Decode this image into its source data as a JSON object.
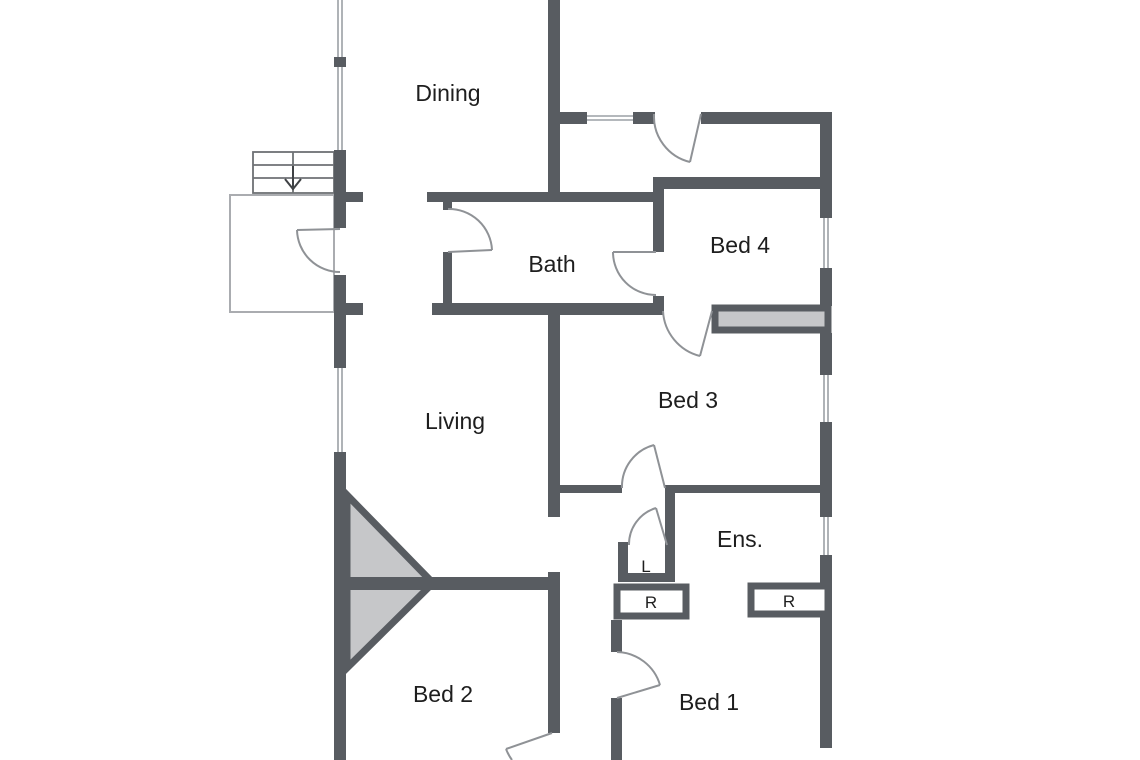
{
  "plan": {
    "type": "residential floor plan",
    "colors": {
      "wall": "#585c61",
      "furniture_fill": "#c6c7c9",
      "thin_line": "#8f9296",
      "window_line": "#9ba0a5",
      "background": "#ffffff",
      "text": "#1e1e1e"
    },
    "rooms": {
      "dining": {
        "label": "Dining"
      },
      "bath": {
        "label": "Bath"
      },
      "bed4": {
        "label": "Bed 4"
      },
      "living": {
        "label": "Living"
      },
      "bed3": {
        "label": "Bed 3"
      },
      "ens": {
        "label": "Ens."
      },
      "bed2": {
        "label": "Bed 2"
      },
      "bed1": {
        "label": "Bed 1"
      }
    },
    "closets": {
      "linen": {
        "label": "L"
      },
      "robe_left": {
        "label": "R"
      },
      "robe_right": {
        "label": "R"
      }
    },
    "stairs": {
      "direction": "down"
    }
  }
}
